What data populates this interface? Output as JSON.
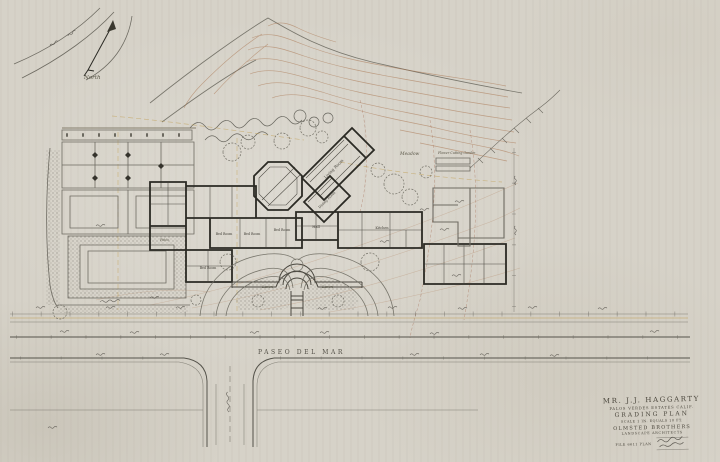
{
  "drawing": {
    "north_label": "North",
    "road_name": "PASEO DEL MAR",
    "labels": {
      "meadow": "Meadow",
      "flower_cutting_garden": "Flower Cutting Garden",
      "lawn": "Lawn",
      "patio": "Patio"
    },
    "rooms": {
      "living": "Living Room",
      "dining": "Dining Room",
      "hall": "Hall",
      "kitchen": "Kitchen",
      "bed": "Bed Room"
    }
  },
  "title_block": {
    "client": "MR. J.J. HAGGARTY",
    "location": "PALOS VERDES ESTATES CALIF.",
    "plan_title": "GRADING PLAN",
    "scale_note": "SCALE 1 IN. EQUALS 10 FT.",
    "firm": "OLMSTED BROTHERS",
    "firm_role": "LANDSCAPE ARCHITECTS",
    "file_note": "FILE 6611 PLAN"
  },
  "colors": {
    "paper": "#d6d2c8",
    "ink_dark": "#2b2a24",
    "ink_gray": "#6e6b62",
    "contour_sepia": "#a8714a",
    "grading_orange": "#c09a4a",
    "lettering": "#4a463c"
  }
}
